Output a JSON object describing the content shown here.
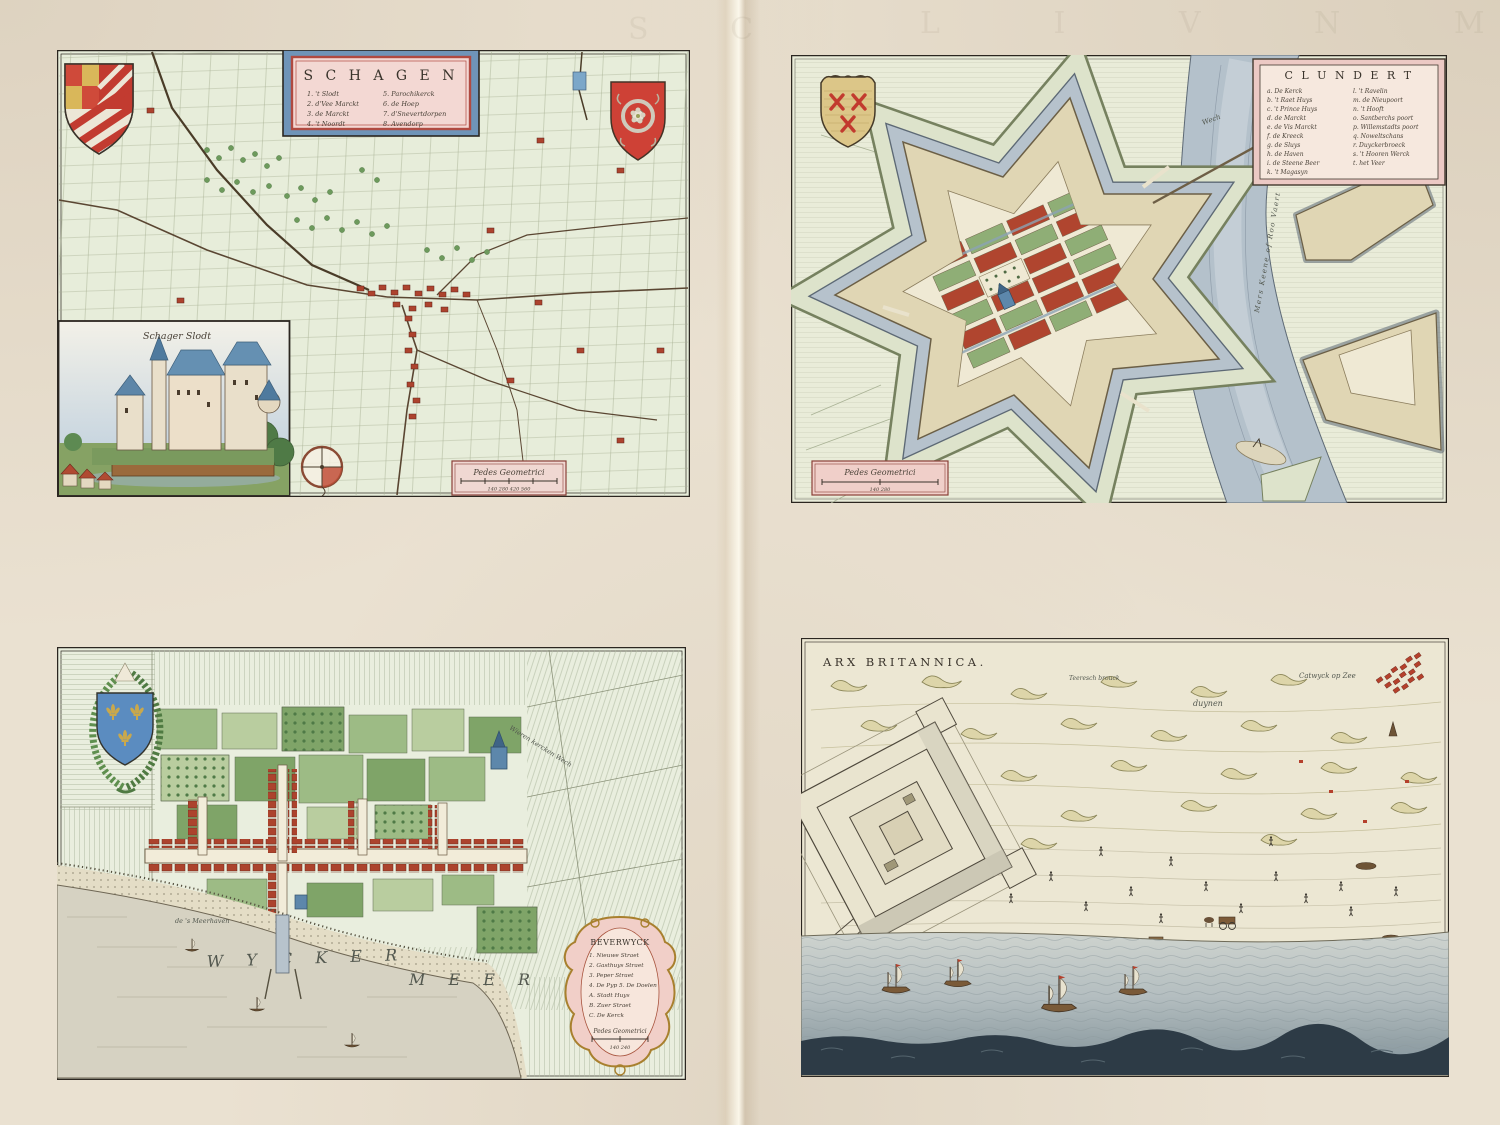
{
  "page": {
    "bleed_left": "S C",
    "bleed_right": "L I V N M E T"
  },
  "palette": {
    "paper": "#eae1d1",
    "map_field_green": "#e7edda",
    "water_blue_gray": "#b4c1cb",
    "building_red": "#ad432e",
    "garden_green": "#8fae76",
    "cartouche_pink": "#f3d8d3",
    "cartouche_frame_blue": "#6f94b8",
    "shield_red": "#ce4136",
    "shield_blue": "#5b8cc0",
    "dune_olive": "#ddd5a9",
    "sea_dark": "#2d3b46"
  },
  "maps": {
    "schagen": {
      "title": "S C H A G E N",
      "legend": [
        {
          "l": "1. 't Slodt",
          "r": "5. Parochikerck"
        },
        {
          "l": "2. d'Vee Marckt",
          "r": "6. de Hoep"
        },
        {
          "l": "3. de Marckt",
          "r": "7. d'Snevertdorpen"
        },
        {
          "l": "4. 't Noordt",
          "r": "8. Avendorp"
        }
      ],
      "inset_label": "Schager Slodt",
      "scale_label": "Pedes Geometrici",
      "scale_numbers": "140    280    420    560"
    },
    "clundert": {
      "title": "C L U N D E R T",
      "legend_left": [
        "a. De Kerck",
        "b. 't Raet Huys",
        "c. 't Prince Huys",
        "d. de Marckt",
        "e. de Vis Marckt",
        "f. de Kreeck",
        "g. de Sluys",
        "h. de Haven",
        "i. de Steene Beer",
        "k. 't Magasyn"
      ],
      "legend_right": [
        "l. 't Ravelin",
        "m. de Nieupoort",
        "n. 't Hooft",
        "o. Santberchs poort",
        "p. Willemstadts poort",
        "q. Noweltschans",
        "r. Duyckerbroeck",
        "s. 't Hooren Werck",
        "t. het Veer"
      ],
      "river_label": "Mers Keene of Roo Vaert",
      "road_label": "Wech",
      "scale_label": "Pedes Geometrici",
      "scale_numbers": "140        280"
    },
    "beverwyck": {
      "title": "BEVERWYCK",
      "legend": [
        "1. Nieuwe Straet",
        "2. Gasthuys Straet",
        "3. Peper Straet",
        "4. De Pyp  5. De Doelen",
        "A. Stadt Huys",
        "B. Zuer Straet",
        "C. De Kerck"
      ],
      "scale_label": "Pedes Geometrici",
      "scale_numbers": "140      240",
      "water_label_1": "W Y C K E R",
      "water_label_2": "M E E R",
      "road_label": "Wieren kercken Wech",
      "harbor_label": "de 's Meerhaven"
    },
    "arx_britannica": {
      "title": "ARX BRITANNICA.",
      "dunes_label": "duynen",
      "village_label": "Catwyck op Zee",
      "field_label": "Teeresch brouck"
    }
  }
}
